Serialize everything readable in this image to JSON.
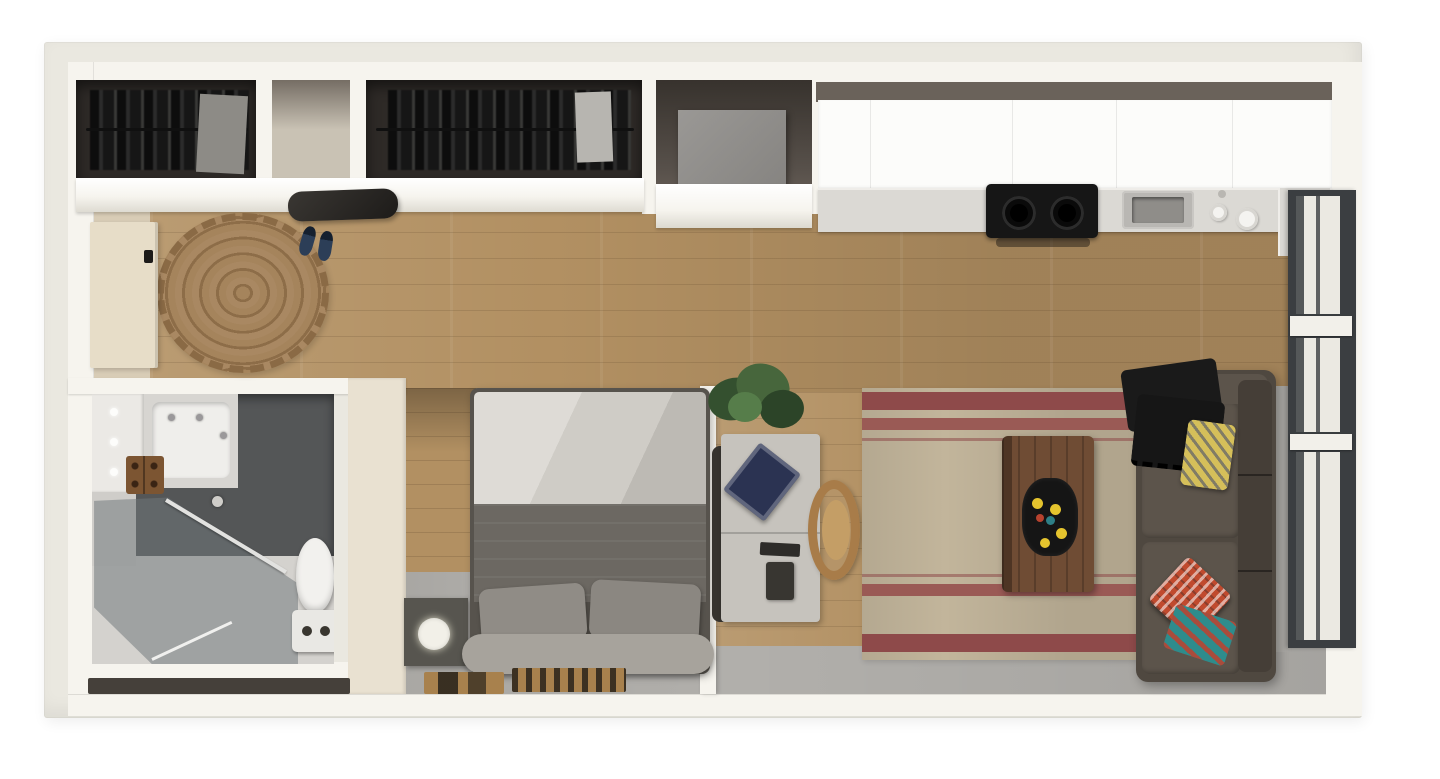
{
  "scene": {
    "kind": "3d-floor-plan-top-view",
    "subject": "studio apartment",
    "rooms": [
      {
        "name": "entry",
        "items": [
          "entry-door",
          "round-jute-rug",
          "wall-console",
          "slip-on-shoes",
          "closet-with-dark-clothes",
          "empty-closet-cubby",
          "long-closet-with-clothes"
        ]
      },
      {
        "name": "utility-niche",
        "items": [
          "appliance-box"
        ]
      },
      {
        "name": "kitchen",
        "items": [
          "upper-cabinets",
          "countertop",
          "two-burner-cooktop",
          "undermount-sink",
          "counter-accessories"
        ]
      },
      {
        "name": "bathroom",
        "items": [
          "vanity-with-sink",
          "vanity-lights",
          "wood-soap-tray",
          "walk-in-glass-shower",
          "shower-towel-bar",
          "toilet"
        ]
      },
      {
        "name": "sleeping-nook",
        "items": [
          "platform-bed",
          "white-sheet",
          "gray-duvet",
          "two-pillows",
          "headboard-bench",
          "nightstand",
          "round-lamp",
          "wood-panel-wall",
          "floor-mats"
        ]
      },
      {
        "name": "office",
        "items": [
          "desk",
          "navy-book",
          "desk-accessories",
          "dark-desk-chair",
          "wood-dining-chair",
          "potted-plant"
        ]
      },
      {
        "name": "living-room",
        "items": [
          "striped-area-rug",
          "wood-coffee-table",
          "black-tray-with-fruit",
          "sofa",
          "black-throw-blanket",
          "yellow-accent-pillow",
          "red-accent-pillow",
          "teal-accent-pillow"
        ]
      },
      {
        "name": "window-wall",
        "items": [
          "floor-to-ceiling-windows",
          "window-sills"
        ]
      }
    ]
  },
  "palette": {
    "bg": "#ffffff",
    "platform": "#eae8e0",
    "wall": "#f6f4ee",
    "wall_cream": "#e9e1d1",
    "wall_dark": "#6a625a",
    "closet": "#2e2a27",
    "closet_empty": "#c9c2b4",
    "garment_gray": "#8d8b86",
    "cabinet": "#fcfcfa",
    "counter": "#dbd9d4",
    "cooktop": "#161616",
    "sink": "#b9b7b3",
    "sink_basin": "#8f8d89",
    "winframe": "#3b3e41",
    "winpane": "#ebe9e2",
    "door": "#e7ddc8",
    "shoe": "#2c3e57",
    "jute": "#a5845c",
    "wood": "#b29062",
    "floor_beige": "#d8ccb6",
    "concrete": "#b1afab",
    "vent_dark": "#45403a",
    "bath_dark": "#545657",
    "bath_floor": "#d4d2ce",
    "porcelain": "#f2f1ee",
    "tray_wood": "#7c5532",
    "nightstand": "#57554f",
    "lamp": "#f2f0e8",
    "sheet": "#cfccc6",
    "duvet": "#6c6862",
    "pillow": "#908c86",
    "bench": "#a7a39c",
    "mat": "#a8814d",
    "desk": "#c6c3bd",
    "book": "#2b3352",
    "chair": "#a87c49",
    "chair_light": "#c49e66",
    "rug": "#c2b59b",
    "rug_stripe": "#8e4a4a",
    "table": "#6f4c34",
    "tray": "#151515",
    "fruit": "#e5c42e",
    "sofa": "#4f4840",
    "sofa_cushion": "#5c544b",
    "throw": "#1a1a1a",
    "py": "#d5bf5a",
    "pr": "#c04a2e",
    "pt": "#2e8c8c"
  }
}
